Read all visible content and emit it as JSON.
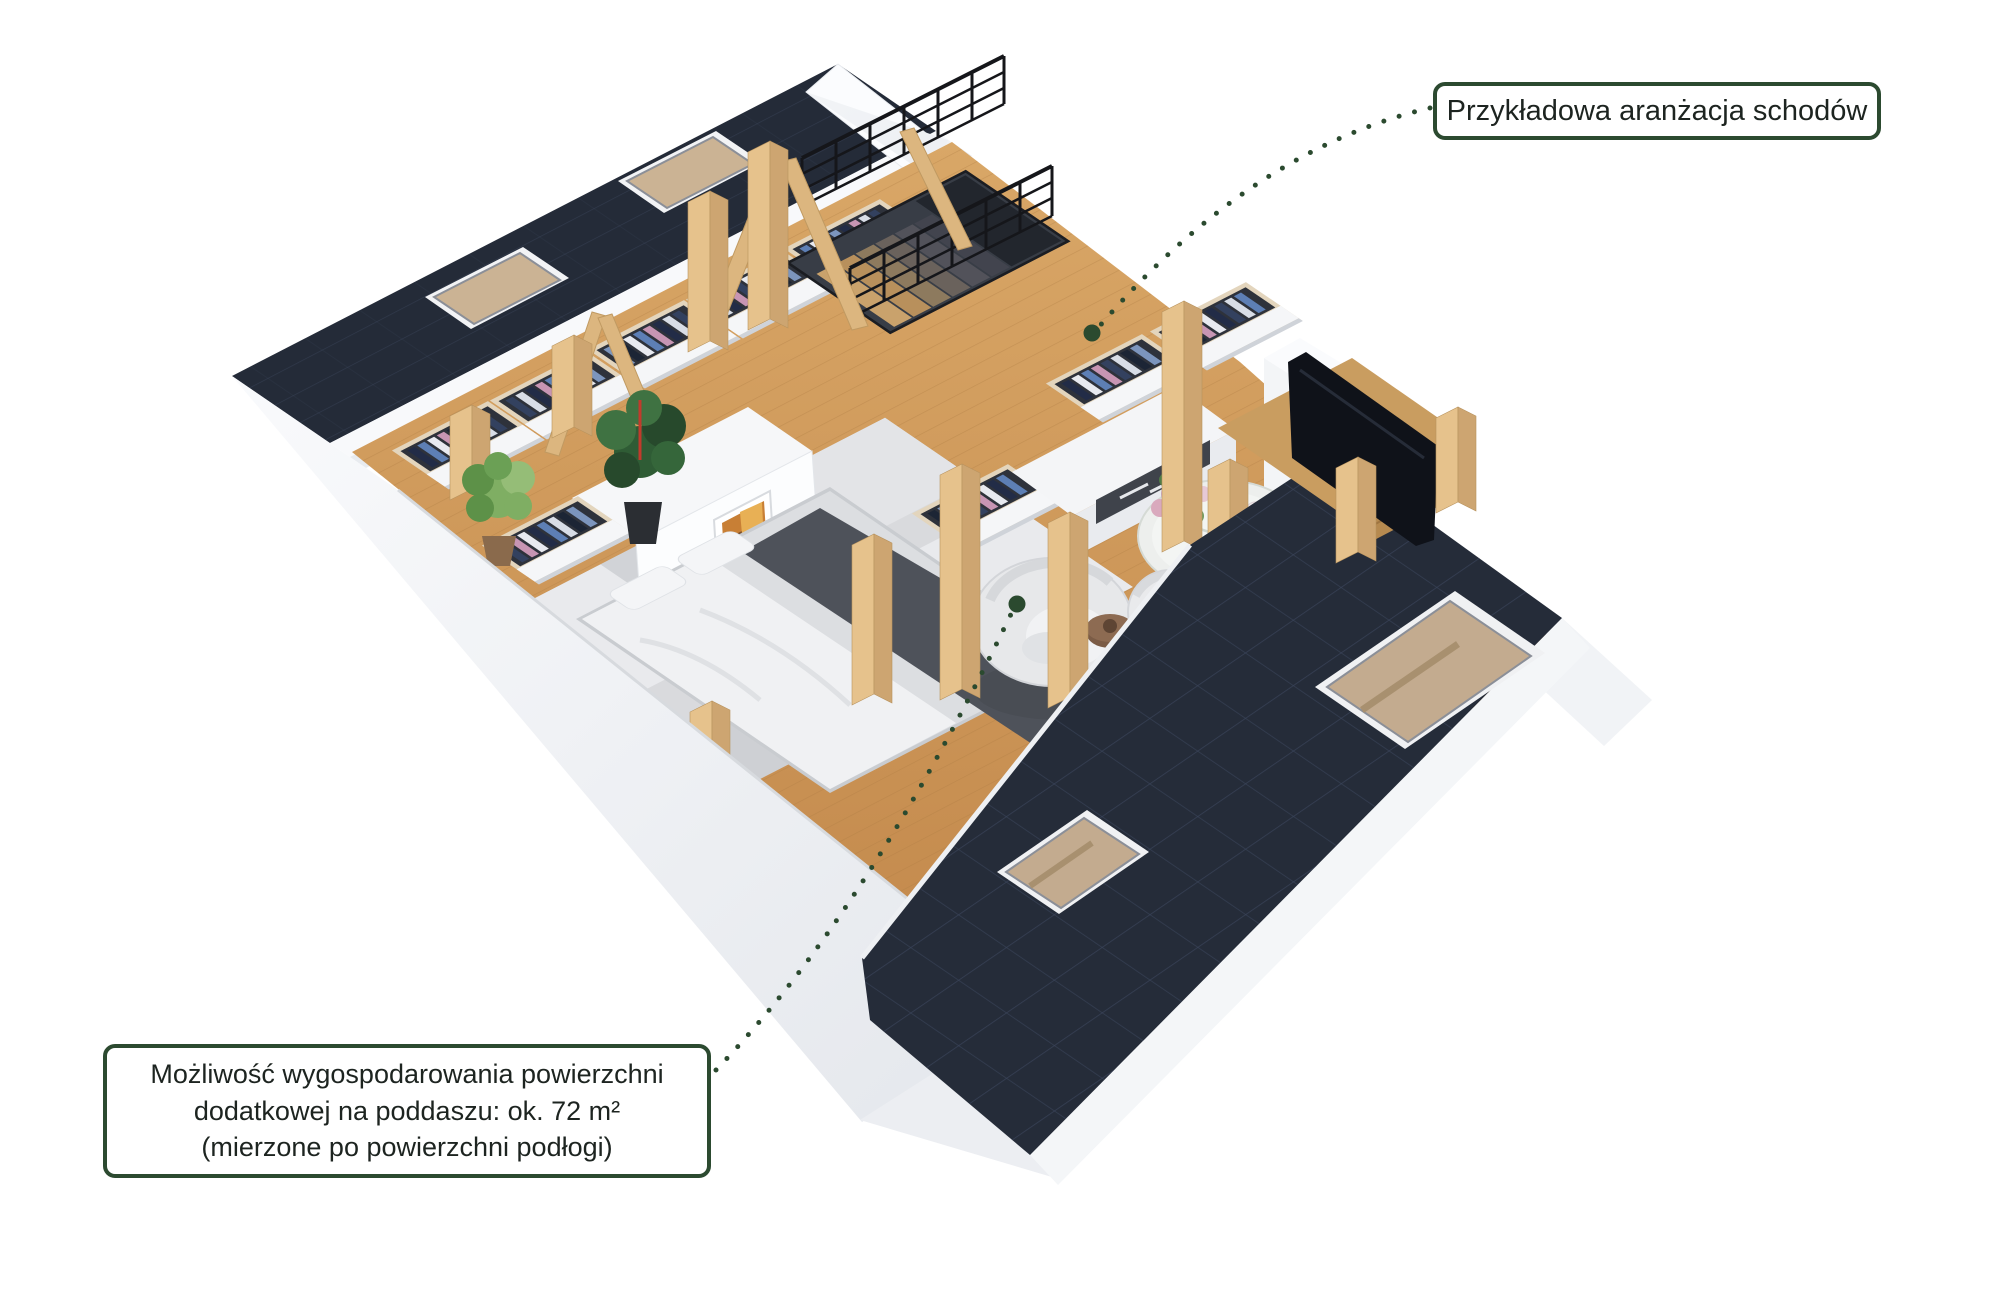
{
  "annotations": {
    "stairs": {
      "label": "Przykładowa aranżacja schodów"
    },
    "attic": {
      "lines": [
        "Możliwość wygospodarowania powierzchni",
        "dodatkowej na poddaszu: ok. 72 m²",
        "(mierzone po powierzchni podłogi)"
      ]
    }
  },
  "colors": {
    "background": "#ffffff",
    "callout_border": "#2c4a30",
    "callout_text": "#1d2420",
    "leader_green": "#2b4a2f",
    "roof_dark": "#242b38",
    "roof_tile_line": "#3a455a",
    "floor_wood": "#cf9a5f",
    "wood_beam": "#e2bd88",
    "wall_white": "#eef0f3",
    "rug_gray": "#d9dadd",
    "bed_runner": "#4e525a"
  },
  "scene": {
    "type": "3d-attic-floorplan-render",
    "elements": [
      "dark-tiled-roof-planes",
      "roof-skylights",
      "oak-wood-floor",
      "exposed-wood-posts-and-trusses",
      "stair-opening-with-black-railing",
      "open-wardrobes-with-clothes",
      "double-bed",
      "area-rug",
      "headboard-wall-with-artwork",
      "white-sideboard",
      "tv-cabinet",
      "tv",
      "marble-coffee-table-with-flowers",
      "egg-chair",
      "armchairs",
      "side-table",
      "potted-plants",
      "white-knee-walls",
      "chimney-block"
    ]
  }
}
